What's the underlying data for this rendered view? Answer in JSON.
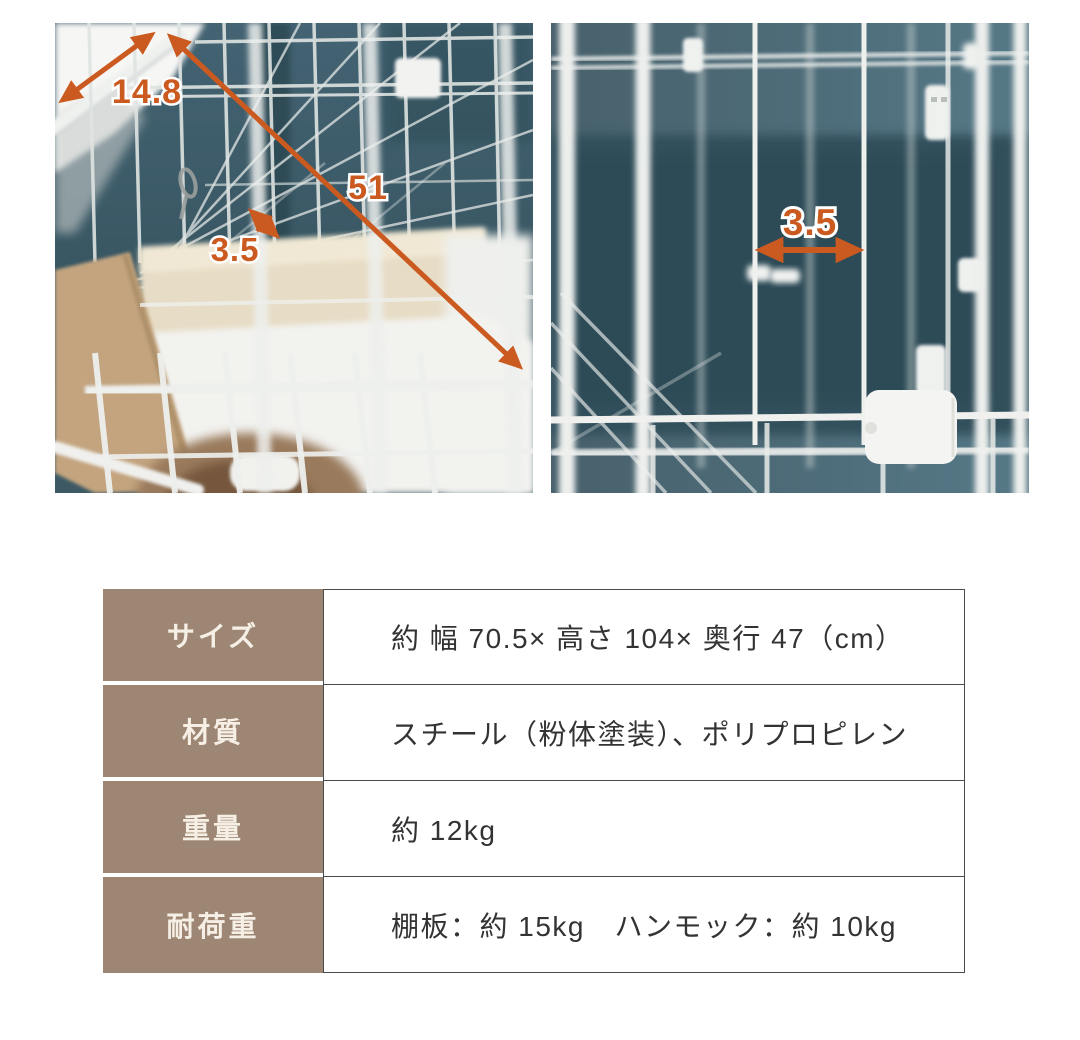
{
  "colors": {
    "annotation_orange": "#cb5a20",
    "wall_teal": "#3a5a66",
    "table_label_bg": "#9d8673",
    "table_label_text": "#f6efe6",
    "table_value_text": "#333333"
  },
  "photos": {
    "left": {
      "annotations": {
        "hammock_edge_cm": "14.8",
        "hammock_diagonal_cm": "51",
        "mesh_gap_cm": "3.5"
      }
    },
    "right": {
      "annotations": {
        "wire_gap_cm": "3.5"
      }
    }
  },
  "spec_table": {
    "rows": [
      {
        "label": "サイズ",
        "value": "約 幅 70.5× 高さ 104× 奥行 47（cm）"
      },
      {
        "label": "材質",
        "value": "スチール（粉体塗装）、ポリプロピレン"
      },
      {
        "label": "重量",
        "value": "約 12kg"
      },
      {
        "label": "耐荷重",
        "value": "棚板：約 15kg　ハンモック：約 10kg"
      }
    ]
  }
}
